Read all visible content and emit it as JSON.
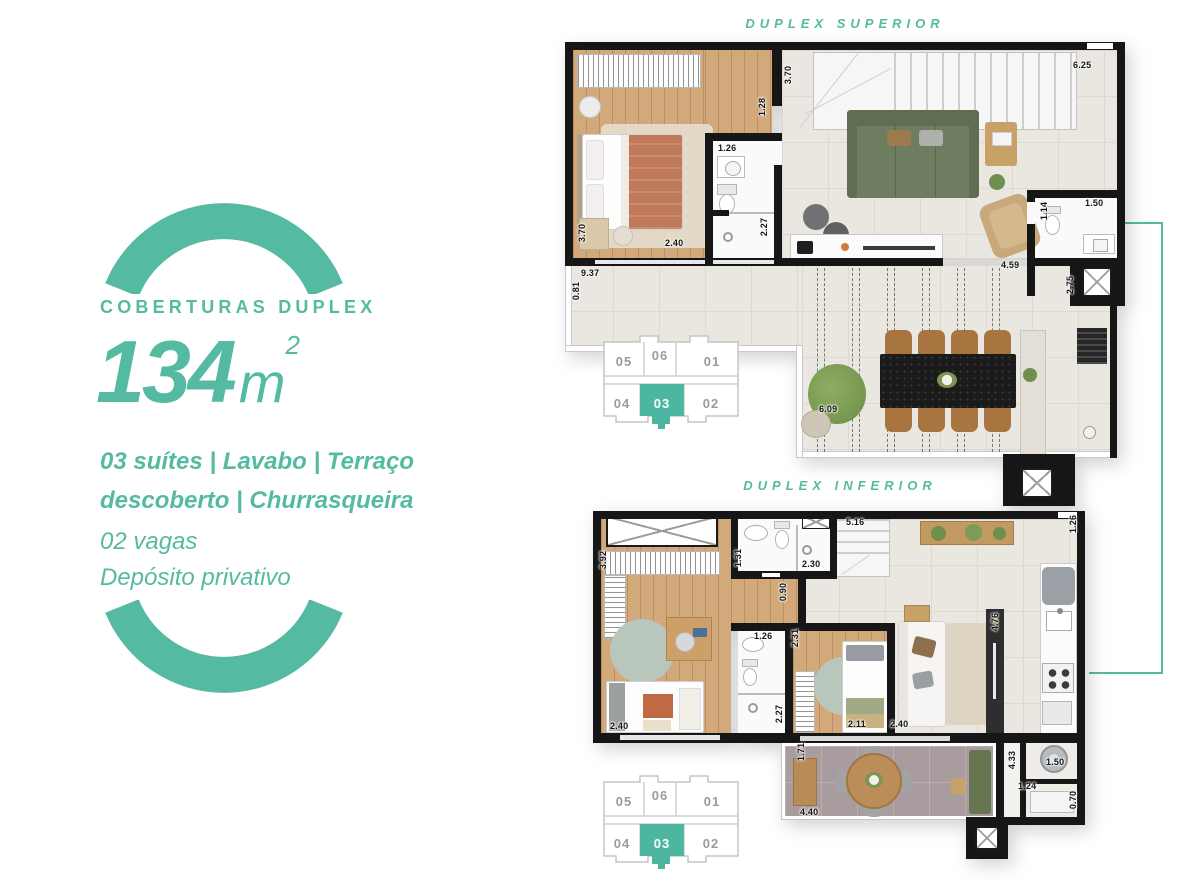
{
  "colors": {
    "accent": "#55baa2",
    "keyplan_highlight": "#4db6a0"
  },
  "panel": {
    "tagline": "COBERTURAS DUPLEX",
    "area_number": "134",
    "area_unit": "m",
    "area_exponent": "2",
    "features_line1": "03 suítes | Lavabo | Terraço",
    "features_line2": "descoberto | Churrasqueira",
    "vagas": "02 vagas",
    "deposito": "Depósito privativo"
  },
  "plans": {
    "superior": {
      "title": "DUPLEX SUPERIOR",
      "dims": [
        "3.70",
        "1.28",
        "6.25",
        "1.26",
        "2.40",
        "3.70",
        "2.27",
        "4.59",
        "1.14",
        "1.50",
        "9.37",
        "0.81",
        "2.75",
        "6.09"
      ]
    },
    "inferior": {
      "title": "DUPLEX INFERIOR",
      "dims": [
        "3.92",
        "1.31",
        "2.30",
        "5.16",
        "1.26",
        "0.90",
        "1.26",
        "2.31",
        "4.76",
        "2.40",
        "2.27",
        "2.11",
        "2.40",
        "1.71",
        "4.40",
        "4.33",
        "1.50",
        "1.24",
        "0.70"
      ]
    }
  },
  "keyplan": {
    "units": [
      "05",
      "06",
      "01",
      "04",
      "03",
      "02"
    ],
    "highlighted_unit": "03"
  }
}
